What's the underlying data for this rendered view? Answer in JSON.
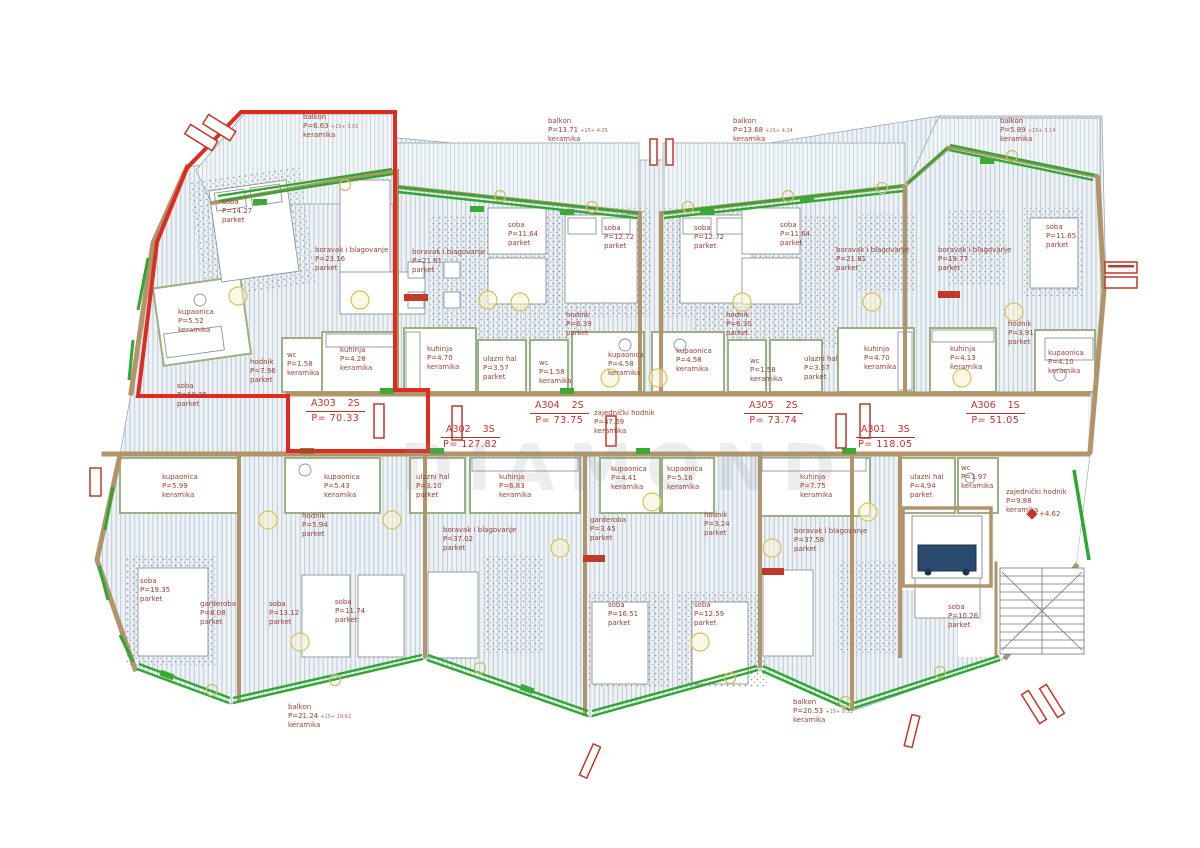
{
  "drawing": {
    "watermark": "DIAMOND",
    "elevation_marker": "+4.62",
    "colors": {
      "highlight_red": "#e02b20",
      "wall_tan": "#b1946a",
      "railing_green": "#2fa832",
      "label_red": "#9c4136",
      "apartment_red": "#c03328"
    }
  },
  "apartments": [
    {
      "id": "A303",
      "type": "2S",
      "area": "P=  70.33",
      "x": 306,
      "y": 398
    },
    {
      "id": "A304",
      "type": "2S",
      "area": "P=  73.75",
      "x": 530,
      "y": 400
    },
    {
      "id": "A302",
      "type": "3S",
      "area": "P= 127.82",
      "x": 441,
      "y": 424
    },
    {
      "id": "A305",
      "type": "2S",
      "area": "P=  73.74",
      "x": 744,
      "y": 400
    },
    {
      "id": "A301",
      "type": "3S",
      "area": "P= 118.05",
      "x": 856,
      "y": 424
    },
    {
      "id": "A306",
      "type": "1S",
      "area": "P=  51.05",
      "x": 966,
      "y": 400
    }
  ],
  "rooms": [
    {
      "name": "soba",
      "area": "P=14.27",
      "floor": "parket",
      "x": 222,
      "y": 198
    },
    {
      "name": "boravak i blagovanje",
      "area": "P=23.16",
      "floor": "parket",
      "x": 315,
      "y": 246
    },
    {
      "name": "kupaonica",
      "area": "P=5.52",
      "floor": "keramika",
      "x": 178,
      "y": 308
    },
    {
      "name": "hodnik",
      "area": "P=7.96",
      "floor": "parket",
      "x": 250,
      "y": 358
    },
    {
      "name": "wc",
      "area": "P=1.58",
      "floor": "keramika",
      "x": 287,
      "y": 351
    },
    {
      "name": "kuhinja",
      "area": "P=4.28",
      "floor": "keramika",
      "x": 340,
      "y": 346
    },
    {
      "name": "soba",
      "area": "P=10.25",
      "floor": "parket",
      "x": 177,
      "y": 382
    },
    {
      "name": "boravak i blagovanje",
      "area": "P=21.81",
      "floor": "parket",
      "x": 412,
      "y": 248
    },
    {
      "name": "soba",
      "area": "P=11.64",
      "floor": "parket",
      "x": 508,
      "y": 221
    },
    {
      "name": "soba",
      "area": "P=12.72",
      "floor": "parket",
      "x": 604,
      "y": 224
    },
    {
      "name": "hodnik",
      "area": "P=6.39",
      "floor": "parket",
      "x": 566,
      "y": 311
    },
    {
      "name": "kuhinja",
      "area": "P=4.70",
      "floor": "keramika",
      "x": 427,
      "y": 345
    },
    {
      "name": "ulazni hal",
      "area": "P=3.57",
      "floor": "parket",
      "x": 483,
      "y": 355
    },
    {
      "name": "wc",
      "area": "P=1.58",
      "floor": "keramika",
      "x": 539,
      "y": 359
    },
    {
      "name": "kupaonica",
      "area": "P=4.58",
      "floor": "keramika",
      "x": 608,
      "y": 351
    },
    {
      "name": "soba",
      "area": "P=12.72",
      "floor": "parket",
      "x": 694,
      "y": 224
    },
    {
      "name": "soba",
      "area": "P=11.64",
      "floor": "parket",
      "x": 780,
      "y": 221
    },
    {
      "name": "hodnik",
      "area": "P=6.30",
      "floor": "parket",
      "x": 726,
      "y": 311
    },
    {
      "name": "kupaonica",
      "area": "P=4.58",
      "floor": "keramika",
      "x": 676,
      "y": 347
    },
    {
      "name": "wc",
      "area": "P=1.58",
      "floor": "keramika",
      "x": 750,
      "y": 357
    },
    {
      "name": "ulazni hal",
      "area": "P=3.57",
      "floor": "parket",
      "x": 804,
      "y": 355
    },
    {
      "name": "kuhinja",
      "area": "P=4.70",
      "floor": "keramika",
      "x": 864,
      "y": 345
    },
    {
      "name": "boravak i blagovanje",
      "area": "P=21.81",
      "floor": "parket",
      "x": 836,
      "y": 246
    },
    {
      "name": "boravak i blagovanje",
      "area": "P=19.77",
      "floor": "parket",
      "x": 938,
      "y": 246
    },
    {
      "name": "kuhinja",
      "area": "P=4.13",
      "floor": "keramika",
      "x": 950,
      "y": 345
    },
    {
      "name": "soba",
      "area": "P=11.65",
      "floor": "parket",
      "x": 1046,
      "y": 223
    },
    {
      "name": "hodnik",
      "area": "P=3.91",
      "floor": "parket",
      "x": 1008,
      "y": 320
    },
    {
      "name": "kupaonica",
      "area": "P=4.10",
      "floor": "keramika",
      "x": 1048,
      "y": 349
    },
    {
      "name": "kupaonica",
      "area": "P=5.99",
      "floor": "keramika",
      "x": 162,
      "y": 473
    },
    {
      "name": "kupaonica",
      "area": "P=5.43",
      "floor": "keramika",
      "x": 324,
      "y": 473
    },
    {
      "name": "hodnik",
      "area": "P=5.94",
      "floor": "parket",
      "x": 302,
      "y": 512
    },
    {
      "name": "soba",
      "area": "P=19.35",
      "floor": "parket",
      "x": 140,
      "y": 577
    },
    {
      "name": "garderoba",
      "area": "P=8.08",
      "floor": "parket",
      "x": 200,
      "y": 600
    },
    {
      "name": "soba",
      "area": "P=13.12",
      "floor": "parket",
      "x": 269,
      "y": 600
    },
    {
      "name": "soba",
      "area": "P=11.74",
      "floor": "parket",
      "x": 335,
      "y": 598
    },
    {
      "name": "ulazni hal",
      "area": "P=3.10",
      "floor": "parket",
      "x": 416,
      "y": 473
    },
    {
      "name": "kuhinja",
      "area": "P=6.83",
      "floor": "keramika",
      "x": 499,
      "y": 473
    },
    {
      "name": "boravak i blagovanje",
      "area": "P=37.02",
      "floor": "parket",
      "x": 443,
      "y": 526
    },
    {
      "name": "garderoba",
      "area": "P=3.45",
      "floor": "parket",
      "x": 590,
      "y": 516
    },
    {
      "name": "kupaonica",
      "area": "P=4.41",
      "floor": "keramika",
      "x": 611,
      "y": 465
    },
    {
      "name": "kupaonica",
      "area": "P=5.16",
      "floor": "keramika",
      "x": 667,
      "y": 465
    },
    {
      "name": "hodnik",
      "area": "P=3.24",
      "floor": "parket",
      "x": 704,
      "y": 511
    },
    {
      "name": "kuhinja",
      "area": "P=7.75",
      "floor": "keramika",
      "x": 800,
      "y": 473
    },
    {
      "name": "boravak i blagovanje",
      "area": "P=37.58",
      "floor": "parket",
      "x": 794,
      "y": 527
    },
    {
      "name": "ulazni hal",
      "area": "P=4.94",
      "floor": "parket",
      "x": 910,
      "y": 473
    },
    {
      "name": "wc",
      "area": "P=1.97",
      "floor": "keramika",
      "x": 961,
      "y": 464
    },
    {
      "name": "soba",
      "area": "P=16.51",
      "floor": "parket",
      "x": 608,
      "y": 601
    },
    {
      "name": "soba",
      "area": "P=12.59",
      "floor": "parket",
      "x": 694,
      "y": 601
    },
    {
      "name": "soba",
      "area": "P=10.26",
      "floor": "parket",
      "x": 948,
      "y": 603
    },
    {
      "name": "zajednički hodnik",
      "area": "P=9.88",
      "floor": "keramika",
      "x": 1006,
      "y": 488
    },
    {
      "name": "zajednički hodnik",
      "area": "P=47.69",
      "floor": "keramika",
      "x": 594,
      "y": 409
    },
    {
      "name": "balkon",
      "area": "P=6.63",
      "note": "+15+ 3.01",
      "floor": "keramika",
      "x": 303,
      "y": 113
    },
    {
      "name": "balkon",
      "area": "P=13.71",
      "note": "+15+ 4.35",
      "floor": "keramika",
      "x": 548,
      "y": 117
    },
    {
      "name": "balkon",
      "area": "P=13.68",
      "note": "+15+ 4.34",
      "floor": "keramika",
      "x": 733,
      "y": 117
    },
    {
      "name": "balkon",
      "area": "P=5.89",
      "note": "+15+ 3.14",
      "floor": "keramika",
      "x": 1000,
      "y": 117
    },
    {
      "name": "balkon",
      "area": "P=21.24",
      "note": "+15+ 19.62",
      "floor": "keramika",
      "x": 288,
      "y": 703
    },
    {
      "name": "balkon",
      "area": "P=20.53",
      "note": "+15+ 9.31",
      "floor": "keramika",
      "x": 793,
      "y": 698
    }
  ]
}
